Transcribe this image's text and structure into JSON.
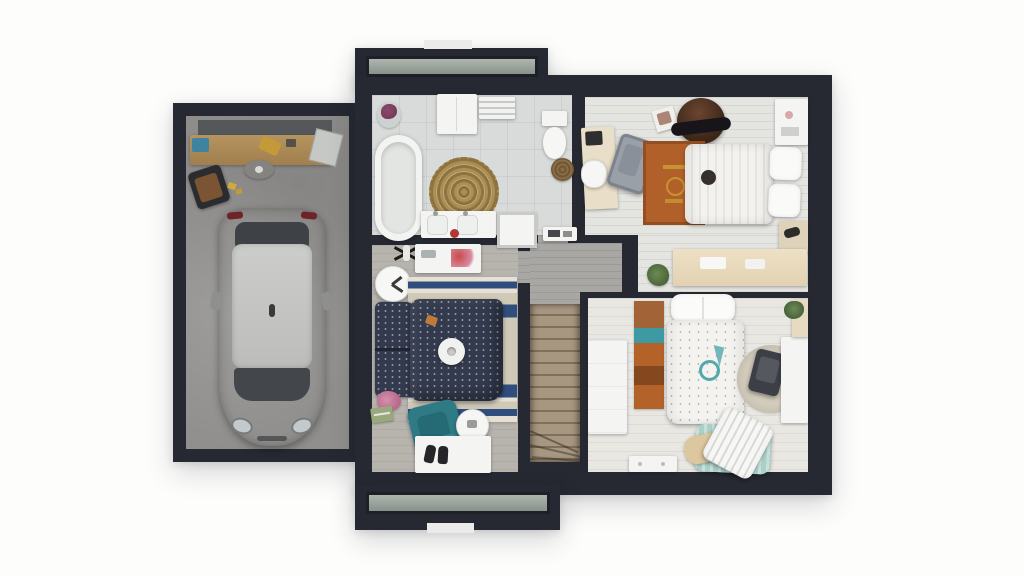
{
  "scene": {
    "type": "3d-floor-plan-render-top-view",
    "text_content": "none",
    "buildings": [
      {
        "name": "garage",
        "floor": "concrete",
        "items": [
          "storage-shelf",
          "workbench",
          "toolbox",
          "power-tool",
          "leaning-board",
          "work-stool",
          "floor-stool",
          "car"
        ]
      },
      {
        "name": "house-upper-floor",
        "rooms": [
          {
            "name": "bathroom",
            "floor": "grey-tile",
            "items": [
              "flower-vase",
              "wall-cabinet",
              "towel-shelf",
              "bathtub",
              "round-jute-rug",
              "toilet",
              "laundry-basket",
              "double-sink-vanity",
              "shower-mat",
              "storage-shelf"
            ]
          },
          {
            "name": "bedroom-top-right",
            "floor": "whitewashed-planks",
            "items": [
              "wall-shelf",
              "papasan-chair",
              "photo-card",
              "desk-with-laptop",
              "desk-chair",
              "lounge-chair",
              "rust-rug-with-gold-emblem",
              "double-bed-striped-duvet",
              "pillows",
              "nightstand",
              "console-table",
              "potted-plant"
            ]
          },
          {
            "name": "hallway",
            "floor": "grey-planks",
            "items": [
              "staircase-with-winders"
            ]
          },
          {
            "name": "bedroom-bottom-left",
            "floor": "grey-wood-planks",
            "items": [
              "ceiling-fan-lamp",
              "white-desk",
              "wall-clock",
              "striped-rug",
              "double-bed-navy-duvet",
              "round-cushion",
              "flowers",
              "book",
              "teal-armchair",
              "round-side-table",
              "white-bench-with-shoes"
            ]
          },
          {
            "name": "bedroom-bottom-right",
            "floor": "whitewashed-planks",
            "items": [
              "white-dresser",
              "runner-rug-rust-teal",
              "single-bed-dotted-duvet",
              "teal-emblem",
              "round-rug",
              "dark-chair",
              "white-desk",
              "tall-cabinet",
              "potted-plant",
              "pillow-pile",
              "low-shelf"
            ]
          }
        ],
        "features": [
          "sage-window-strip-top",
          "sage-window-strip-bottom",
          "white-sill-top",
          "white-sill-bottom"
        ]
      }
    ]
  },
  "colors": {
    "wall": "#262931",
    "concrete": "#908f8d",
    "bathfloor": "#d8dbd9",
    "plankwhite": "#e4e4e1",
    "plankwarm": "#e9e7e2",
    "hallfloor": "#a8a7a4",
    "bed2floor": "#b7b4ae",
    "stairtread": "#a79680",
    "stairgap": "#7f7059",
    "wood": "#ab8a59",
    "rust": "#b2602a",
    "tealrug": "#3e9aa2",
    "tealchair": "#2e7b86",
    "navy": "#333a4d",
    "rugnavy": "#2f4e7e",
    "rugbeige": "#cfc9b8",
    "mint": "#abd0c8",
    "papasan": "#4a3022",
    "windowglass": "#9aa49c",
    "sill": "#ebebe9",
    "consoletan": "#ead fc6",
    "desktan": "#e9dfc9",
    "roundrug": "#d3ccbc",
    "carbody": "#9c9c9a",
    "carroof": "#c7c8c6",
    "carglass": "#42454a",
    "gold": "#c9a035"
  }
}
